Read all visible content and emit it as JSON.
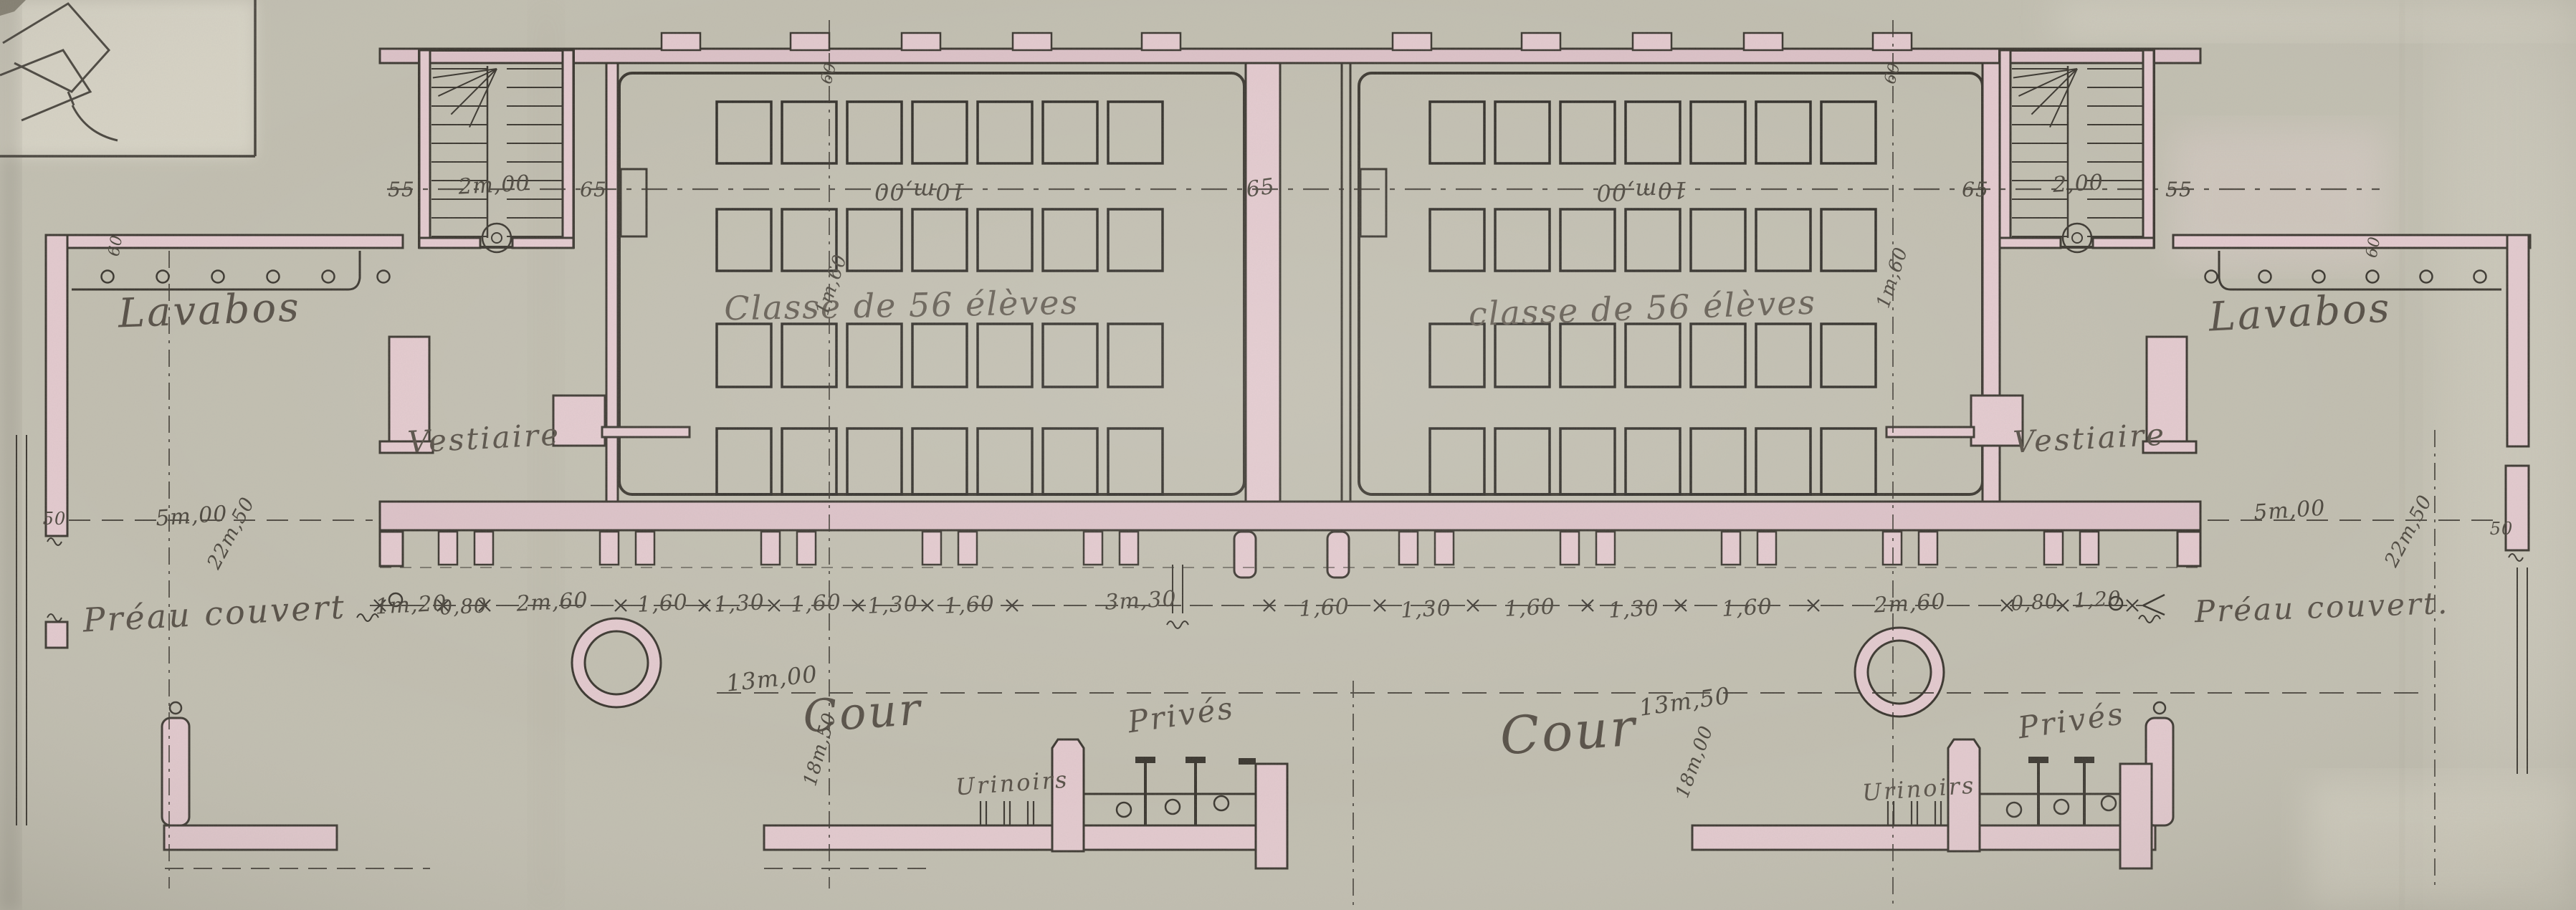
{
  "palette": {
    "paper": "#c1beb0",
    "paper_light": "#d8d4c6",
    "ink": "#39352e",
    "wall_wash_pink": "#e3c9ce",
    "handwriting": "#564f46"
  },
  "rooms": {
    "lavabos_left": "Lavabos",
    "lavabos_right": "Lavabos",
    "vestiaire_left": "Vestiaire",
    "vestiaire_right": "Vestiaire",
    "classe_left": "Classe de 56 élèves",
    "classe_right": "classe de 56 élèves",
    "preau_left": "Préau couvert",
    "preau_right": "Préau couvert.",
    "cour_left": "Cour",
    "cour_right": "Cour",
    "prives_left": "Privés",
    "prives_right": "Privés",
    "urinoirs_left": "Urinoirs",
    "urinoirs_right": "Urinoirs"
  },
  "dimensions": {
    "stair_left": [
      "55",
      "2m,00",
      "65"
    ],
    "stair_right": [
      "65",
      "2,00",
      "55"
    ],
    "classroom_left_width": "10m,00",
    "classroom_right_width": "10m,00",
    "center_wall": "65",
    "desk_pitch_left": "1m,60",
    "desk_pitch_right": "1m,60",
    "chain": [
      "1m,20",
      "0,80",
      "2m,60",
      "1,60",
      "1,30",
      "1,60",
      "1,30",
      "1,60",
      "3m,30",
      "1,60",
      "1,30",
      "1,60",
      "1,30",
      "1,60",
      "2m,60",
      "0,80",
      "1,20"
    ],
    "preau_depth_left": "5m,00",
    "preau_depth_right": "5m,00",
    "site_depth_left": "22m,50",
    "site_depth_right": "22m,50",
    "wall_thickness_left": "50",
    "wall_thickness_right": "50",
    "door_top_left": "60",
    "door_top_right": "60",
    "door_side_left": "60",
    "door_side_right": "60",
    "cour_width_left": "13m,00",
    "cour_width_right": "13m,50",
    "cour_depth_left": "18m,50",
    "cour_depth_right": "18m,00"
  }
}
